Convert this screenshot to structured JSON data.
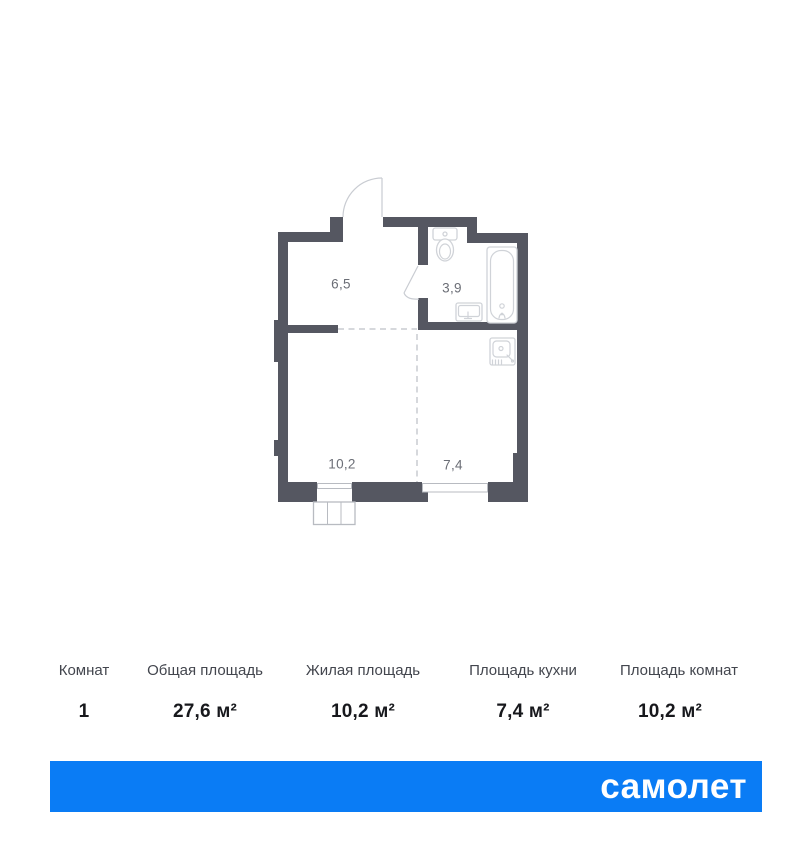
{
  "plan": {
    "rooms": [
      {
        "name": "hallway",
        "area": "6,5"
      },
      {
        "name": "bathroom",
        "area": "3,9"
      },
      {
        "name": "living",
        "area": "10,2"
      },
      {
        "name": "kitchen",
        "area": "7,4"
      }
    ]
  },
  "table": {
    "columns": [
      {
        "header": "Комнат",
        "value": "1"
      },
      {
        "header": "Общая площадь",
        "value": "27,6 м²"
      },
      {
        "header": "Жилая площадь",
        "value": "10,2 м²"
      },
      {
        "header": "Площадь кухни",
        "value": "7,4 м²"
      },
      {
        "header": "Площадь комнат",
        "value": "10,2 м²"
      }
    ]
  },
  "footer": {
    "logo_text": "самолет"
  },
  "colors": {
    "brand_blue": "#0a7cf5",
    "wall": "#555761",
    "room_label": "#6b6e76",
    "logo_text": "#ffffff"
  }
}
